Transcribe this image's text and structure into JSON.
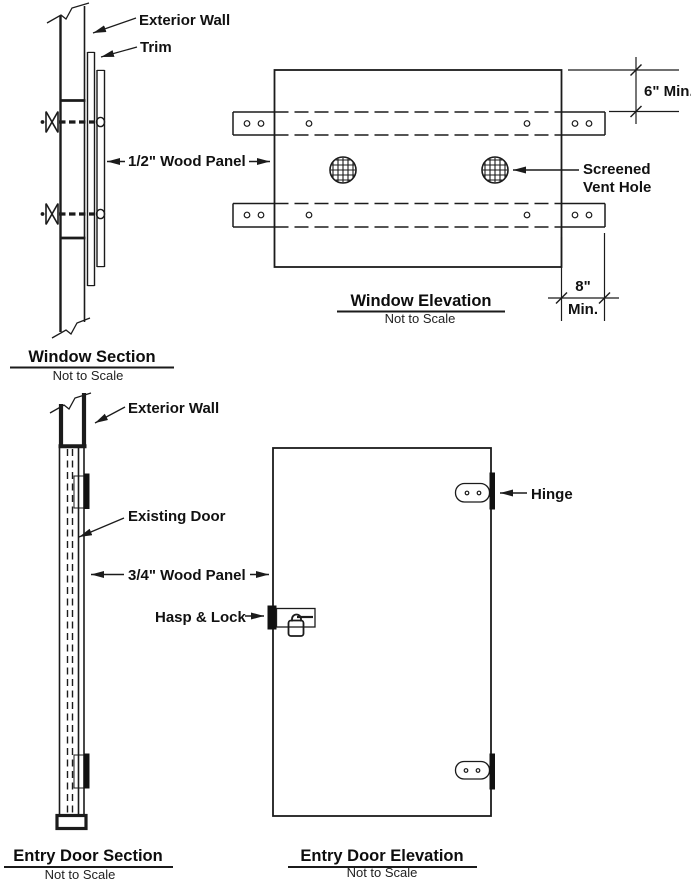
{
  "window_section": {
    "title": "Window Section",
    "subtitle": "Not to Scale",
    "labels": {
      "exterior_wall": "Exterior Wall",
      "trim": "Trim",
      "wood_panel": "1/2\" Wood Panel"
    }
  },
  "window_elevation": {
    "title": "Window Elevation",
    "subtitle": "Not to Scale",
    "labels": {
      "screened_line1": "Screened",
      "screened_line2": "Vent Hole"
    },
    "dimensions": {
      "top_offset": "6\" Min.",
      "side_offset_value": "8\"",
      "side_offset_unit": "Min."
    }
  },
  "entry_door_section": {
    "title": "Entry Door Section",
    "subtitle": "Not to Scale",
    "labels": {
      "exterior_wall": "Exterior Wall",
      "existing_door": "Existing Door",
      "wood_panel": "3/4\" Wood Panel",
      "hasp_lock": "Hasp & Lock"
    }
  },
  "entry_door_elevation": {
    "title": "Entry Door Elevation",
    "subtitle": "Not to Scale",
    "labels": {
      "hinge": "Hinge"
    }
  },
  "colors": {
    "line": "#1b1b1b",
    "background": "#ffffff"
  }
}
